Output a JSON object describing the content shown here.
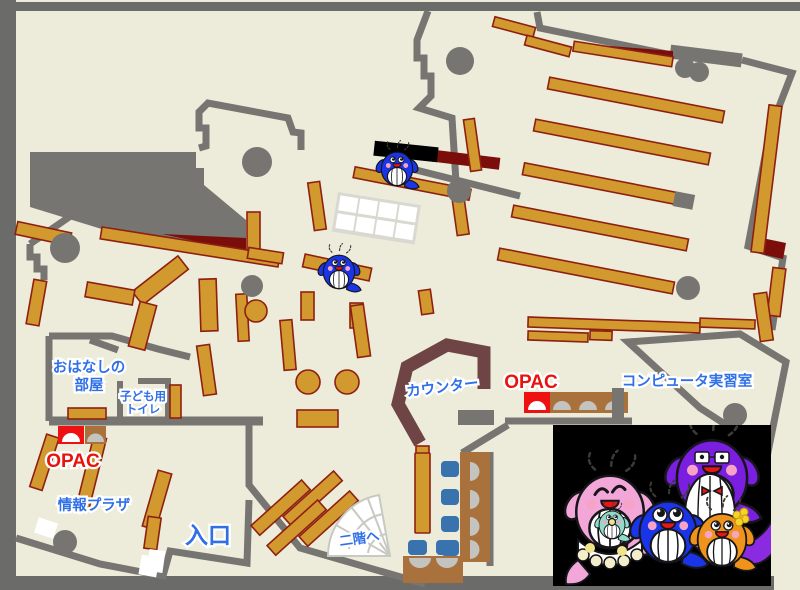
{
  "title": "library-first-floor-map",
  "palette": {
    "floor": "#edecdb",
    "frame": "#6b6b69",
    "wall": "#767571",
    "shelf": "#d2992f",
    "shelf_border": "#8e2011",
    "darkred": "#7b0d0b",
    "counter": "#6e4444",
    "desk": "#a9713c",
    "chair": "#3873ad",
    "opac_red": "#ee1111",
    "label_blue": "#2f6fe8",
    "label_red": "#e8130c"
  },
  "labels": {
    "ohanashi_line1": "おはなしの",
    "ohanashi_line2": "部屋",
    "kids_toilet_line1": "子ども用",
    "kids_toilet_line2": "トイレ",
    "opac_left": "OPAC",
    "opac_right": "OPAC",
    "counter": "カウンター",
    "computer_room": "コンピュータ実習室",
    "info_plaza": "情報プラザ",
    "entrance": "入口",
    "to_second_floor": "二階へ"
  },
  "mascots": {
    "family": "whale-family-illustration",
    "members": [
      "pink-mother-whale",
      "teal-baby-whale",
      "blue-kid-whale",
      "purple-father-whale",
      "orange-kid-whale"
    ],
    "map_sprites": [
      "blue-whale-mascot",
      "blue-whale-mascot"
    ]
  }
}
